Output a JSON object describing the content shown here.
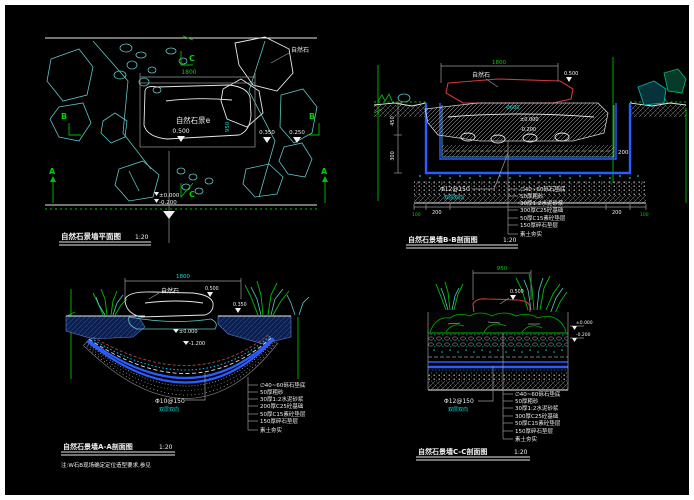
{
  "sheet": {
    "bg_color": "#000000",
    "frame_color": "#ffffff",
    "accent_green": "#00d200",
    "accent_cyan": "#00e0e0",
    "accent_blue": "#2b5cff",
    "accent_red": "#cf3a3a"
  },
  "plan": {
    "title": "自然石景墙平面图",
    "scale": "1:20",
    "stone_label": "自然石",
    "center_text": "自然石景e",
    "dim_width": "1800",
    "dim_height": "950",
    "elev_stone": "0.500",
    "elev_right1": "0.350",
    "elev_right2": "0.250",
    "elev_zero": "±0.000",
    "elev_neg": "-0.200",
    "marker_a": "A",
    "marker_b": "B",
    "marker_c": "C"
  },
  "section_bb": {
    "title": "自然石景墙B-B剖面图",
    "scale": "1:20",
    "stone_label": "自然石",
    "stone_dia": "Φ600",
    "dim_top": "1800",
    "dim_450": "450",
    "dim_300": "300",
    "dim_200": "200",
    "dim_100": "100",
    "elev_top": "0.500",
    "elev_zero": "±0.000",
    "elev_neg": "-0.200",
    "rebar": "Φ12@150",
    "rebar_note": "双层双向",
    "callouts": [
      "∅40~60砾石垫底",
      "50厚粗砂",
      "30厚1:2水泥砂浆",
      "300厚C25砼基础",
      "50厚C15素砼垫层",
      "150厚碎石垫层",
      "素土夯实"
    ]
  },
  "section_aa": {
    "title": "自然石景墙A-A剖面图",
    "scale": "1:20",
    "stone_label": "自然石",
    "dim_top": "1800",
    "elev_stone": "0.500",
    "elev_right": "0.350",
    "elev_zero": "±0.000",
    "elev_neg": "-1.200",
    "rebar": "Φ10@150",
    "rebar_note": "双层双向",
    "note": "注:W石B现场确定定位造型要求,参见",
    "callouts": [
      "∅40~60砾石垫底",
      "50厚粗砂",
      "30厚1:2水泥砂浆",
      "200厚C25砼基础",
      "50厚C15素砼垫层",
      "150厚碎石垫层",
      "素土夯实"
    ]
  },
  "section_cc": {
    "title": "自然石景墙C-C剖面图",
    "scale": "1:20",
    "dim_top": "950",
    "elev_stone": "0.500",
    "elev_zero": "±0.000",
    "elev_neg": "-0.200",
    "rebar": "Φ12@150",
    "rebar_note": "双层双向",
    "callouts": [
      "∅40~60砾石垫底",
      "50厚粗砂",
      "30厚1:2水泥砂浆",
      "300厚C25砼基础",
      "50厚C15素砼垫层",
      "150厚碎石垫层",
      "素土夯实"
    ]
  }
}
